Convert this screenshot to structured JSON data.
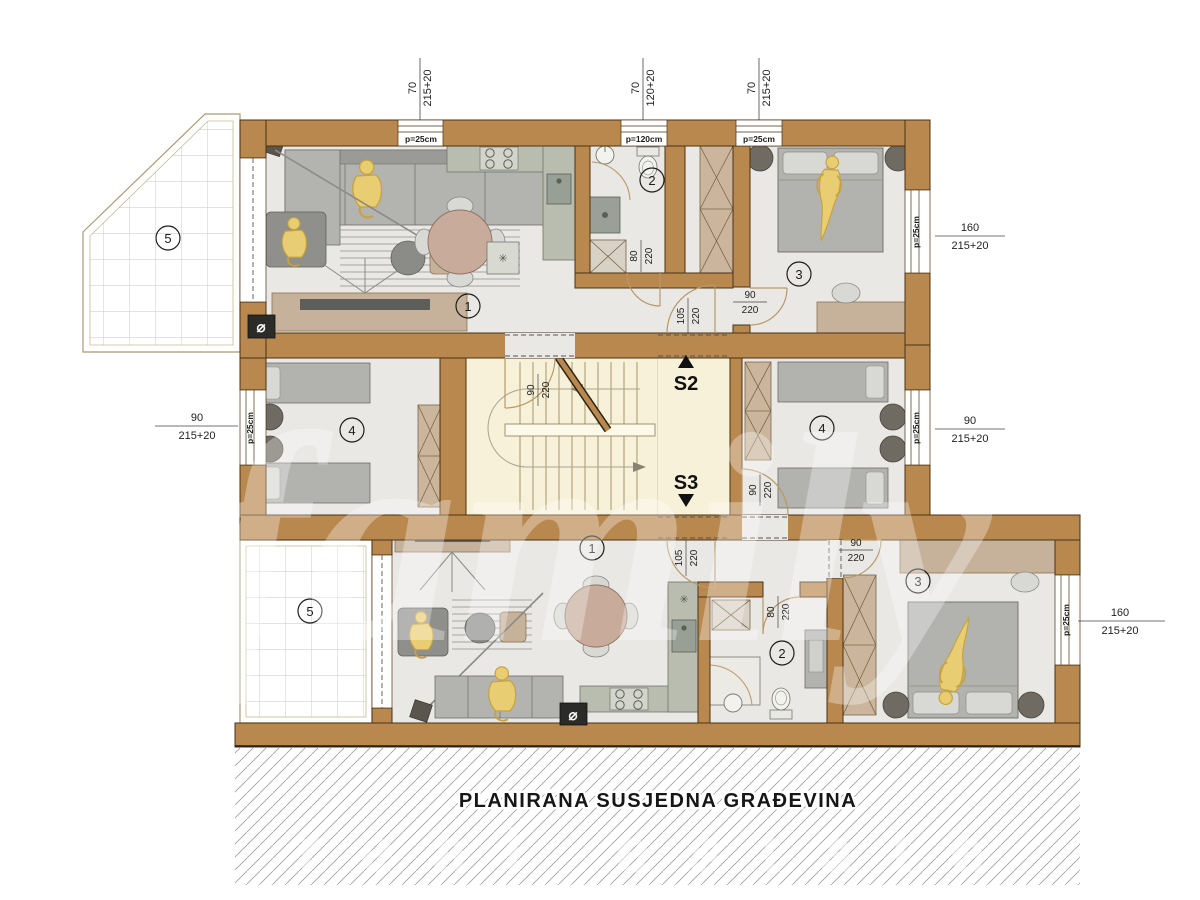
{
  "neighbor_label": "PLANIRANA SUSJEDNA GRAĐEVINA",
  "watermark": {
    "primary": "family",
    "secondary": "real estate"
  },
  "stairs": {
    "up": "S2",
    "down": "S3"
  },
  "rooms": {
    "apt_top": {
      "living": "1",
      "bath": "2",
      "bedroom": "3",
      "bedroom2": "4",
      "terrace": "5"
    },
    "apt_bottom": {
      "living": "1",
      "bath": "2",
      "bedroom": "3",
      "bedroom2": "4",
      "terrace": "5"
    }
  },
  "dims": {
    "top": [
      {
        "num": "70",
        "den": "215+20"
      },
      {
        "num": "70",
        "den": "120+20"
      },
      {
        "num": "70",
        "den": "215+20"
      }
    ],
    "right_top": {
      "num": "160",
      "den": "215+20"
    },
    "right_mid": {
      "num": "90",
      "den": "215+20"
    },
    "left_mid": {
      "num": "90",
      "den": "215+20"
    },
    "right_bottom": {
      "num": "160",
      "den": "215+20"
    }
  },
  "doors": {
    "top_bath": {
      "num": "80",
      "den": "220"
    },
    "top_bed3": {
      "num": "90",
      "den": "220"
    },
    "top_entry": {
      "num": "105",
      "den": "220"
    },
    "bed4_left": {
      "num": "90",
      "den": "220"
    },
    "bed4_right": {
      "num": "90",
      "den": "220"
    },
    "bottom_entry": {
      "num": "105",
      "den": "220"
    },
    "bottom_bed3": {
      "num": "90",
      "den": "220"
    },
    "bottom_bath": {
      "num": "80",
      "den": "220"
    }
  },
  "parapets": {
    "top1": "p=25cm",
    "top2": "p=120cm",
    "top3": "p=25cm",
    "left": "p=25cm",
    "right_top": "p=25cm",
    "right_mid": "p=25cm",
    "right_bottom": "p=25cm"
  },
  "symbols": {
    "diameter": "⌀",
    "snowflake": "✳"
  }
}
